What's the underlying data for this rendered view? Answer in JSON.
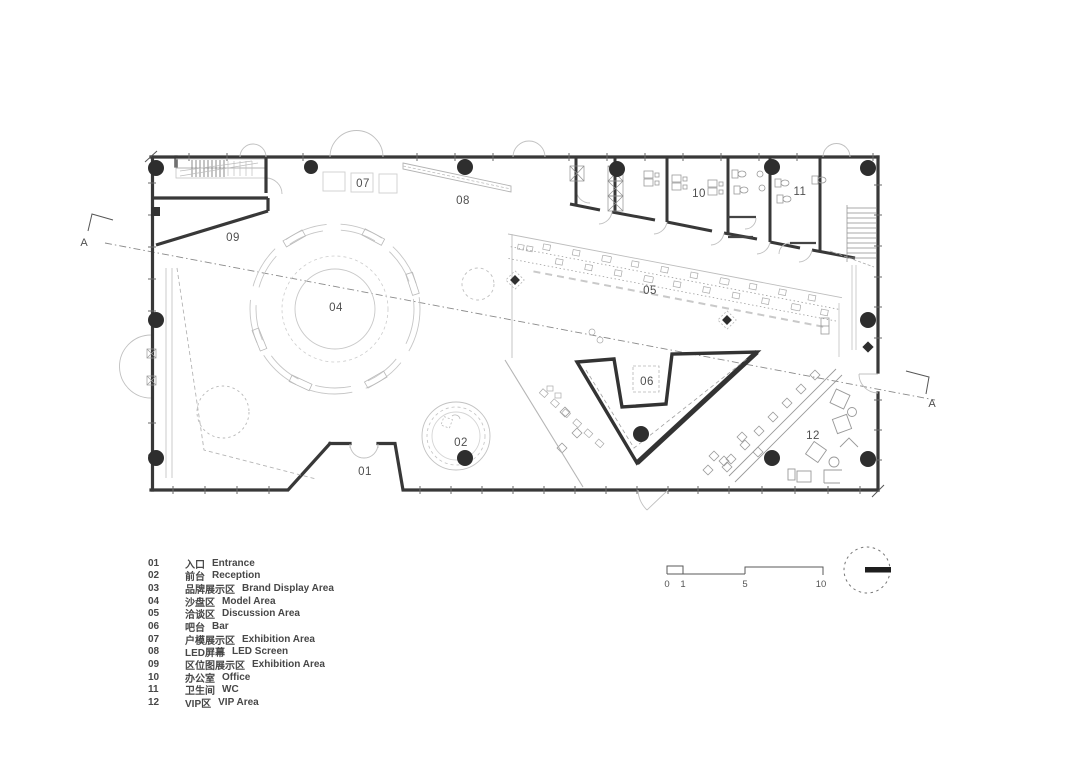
{
  "colors": {
    "wall": "#383838",
    "thin_line": "#b9b9b9",
    "text": "#4a4a4a"
  },
  "plan": {
    "section_label": "A",
    "room_labels": [
      {
        "num": "01"
      },
      {
        "num": "02"
      },
      {
        "num": "04"
      },
      {
        "num": "05"
      },
      {
        "num": "06"
      },
      {
        "num": "07"
      },
      {
        "num": "08"
      },
      {
        "num": "09"
      },
      {
        "num": "10"
      },
      {
        "num": "11"
      },
      {
        "num": "12"
      }
    ]
  },
  "legend": {
    "items": [
      {
        "num": "01",
        "cn": "入口",
        "en": "Entrance"
      },
      {
        "num": "02",
        "cn": "前台",
        "en": "Reception"
      },
      {
        "num": "03",
        "cn": "品牌展示区",
        "en": "Brand Display Area"
      },
      {
        "num": "04",
        "cn": "沙盘区",
        "en": "Model Area"
      },
      {
        "num": "05",
        "cn": "洽谈区",
        "en": "Discussion Area"
      },
      {
        "num": "06",
        "cn": "吧台",
        "en": "Bar"
      },
      {
        "num": "07",
        "cn": "户模展示区",
        "en": "Exhibition Area"
      },
      {
        "num": "08",
        "cn": "LED屏幕",
        "en": "LED Screen"
      },
      {
        "num": "09",
        "cn": "区位图展示区",
        "en": "Exhibition Area"
      },
      {
        "num": "10",
        "cn": "办公室",
        "en": "Office"
      },
      {
        "num": "11",
        "cn": "卫生间",
        "en": "WC"
      },
      {
        "num": "12",
        "cn": "VIP区",
        "en": "VIP Area"
      }
    ]
  },
  "scale_bar": {
    "labels": [
      "0",
      "1",
      "5",
      "10"
    ]
  }
}
